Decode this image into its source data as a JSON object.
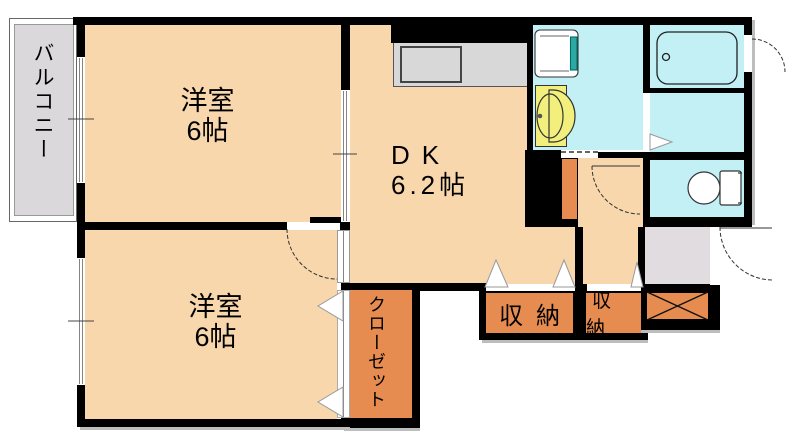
{
  "plan_title": "apartment-floor-plan",
  "labels": {
    "balcony": "バルコニー",
    "room_top_name": "洋室",
    "room_top_size": "6帖",
    "room_bottom_name": "洋室",
    "room_bottom_size": "6帖",
    "dk_name": "DK",
    "dk_size": "6.2帖",
    "closet": "クローゼット",
    "storage_left": "収納",
    "storage_right": "収納"
  },
  "fixtures": {
    "bathtub": "bathtub-icon",
    "toilet": "toilet-icon",
    "washing_machine_pan": "washing-machine-pan-icon",
    "vanity_sink": "vanity-sink-icon",
    "kitchen_sink": "kitchen-counter-sink-icon",
    "shoe_cabinet": "shoe-cabinet-x-icon"
  },
  "colors": {
    "wall": "#000000",
    "room_fill": "#F8D7AD",
    "storage_fill": "#E68C50",
    "wet_area_fill": "#C2F0F4",
    "entry_fill": "#E0DCE0",
    "balcony_fill": "#DBD8DC",
    "counter_fill": "#D8D8D8",
    "sink_fill": "#F2EF7D",
    "washer_accent": "#2CA9A4"
  }
}
